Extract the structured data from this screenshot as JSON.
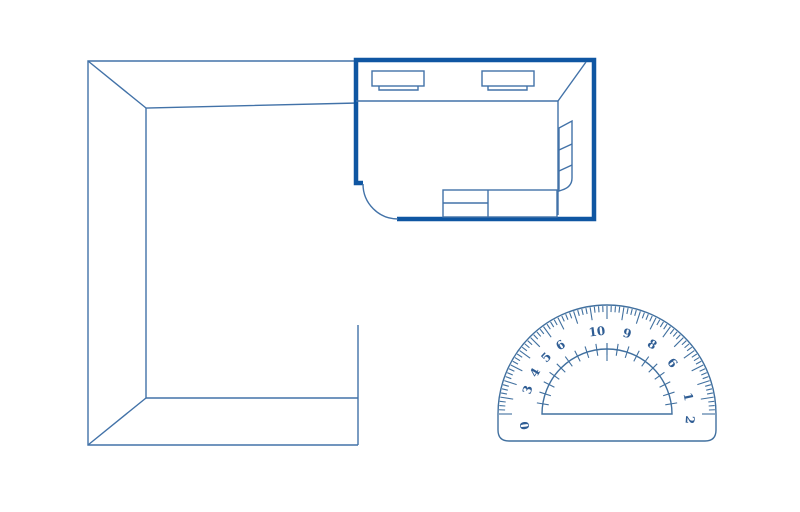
{
  "colors": {
    "line": "#4272a8",
    "bold_wall": "#0f56a2",
    "protractor_line": "#41709f",
    "protractor_label": "#2f5d94",
    "background": "#ffffff"
  },
  "drawing": {
    "description_names": {
      "left_structure": "outer-wall-frame",
      "highlighted_room": "room-floor-plan",
      "tool": "protractor"
    }
  },
  "protractor": {
    "center": {
      "x": 607,
      "y": 414
    },
    "outer_radius": 109,
    "inner_radius": 65,
    "label_radius": 83,
    "label_font_size": 12,
    "minor_tick_step_deg": 2.25,
    "major_tick_step_deg": 9,
    "minor_tick_len": 7,
    "major_tick_len": 14,
    "inner_tick_step_deg": 9,
    "labels": [
      {
        "angle": 188,
        "text": "0"
      },
      {
        "angle": 163,
        "text": "3"
      },
      {
        "angle": 150,
        "text": "4"
      },
      {
        "angle": 137,
        "text": "5"
      },
      {
        "angle": 124,
        "text": "6"
      },
      {
        "angle": 97,
        "text": "10"
      },
      {
        "angle": 76,
        "text": "9"
      },
      {
        "angle": 57,
        "text": "8"
      },
      {
        "angle": 38,
        "text": "6"
      },
      {
        "angle": 12,
        "text": "1"
      },
      {
        "angle": -4,
        "text": "2"
      }
    ]
  }
}
